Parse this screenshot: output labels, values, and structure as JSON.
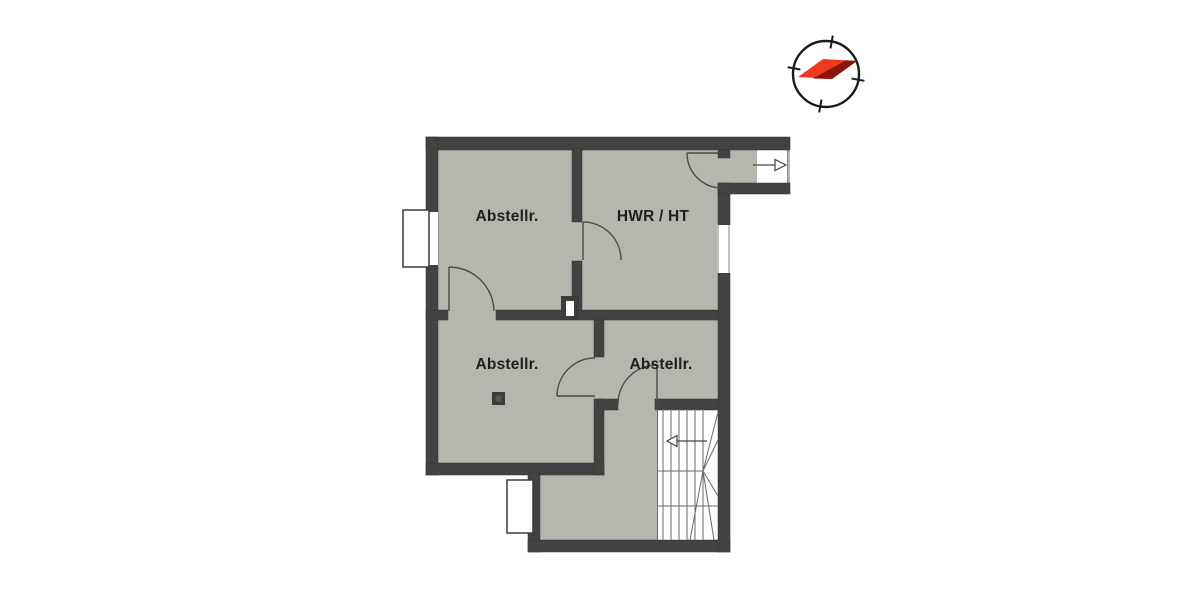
{
  "plan": {
    "title": "basement-floor-plan",
    "rooms": [
      {
        "id": "storage-top-left",
        "label": "Abstellr."
      },
      {
        "id": "utility-room",
        "label": "HWR / HT"
      },
      {
        "id": "storage-mid-left",
        "label": "Abstellr."
      },
      {
        "id": "storage-mid-right",
        "label": "Abstellr."
      }
    ],
    "colors": {
      "wall": "#424242",
      "floor": "#b6b6ae",
      "needle_bright": "#ef3a23",
      "needle_dark": "#8e1408",
      "linework": "#4a4a4a"
    },
    "icons": {
      "compass": "compass-rose",
      "entrance_arrow": "arrow-right",
      "stair_direction_arrow": "arrow-left"
    }
  }
}
